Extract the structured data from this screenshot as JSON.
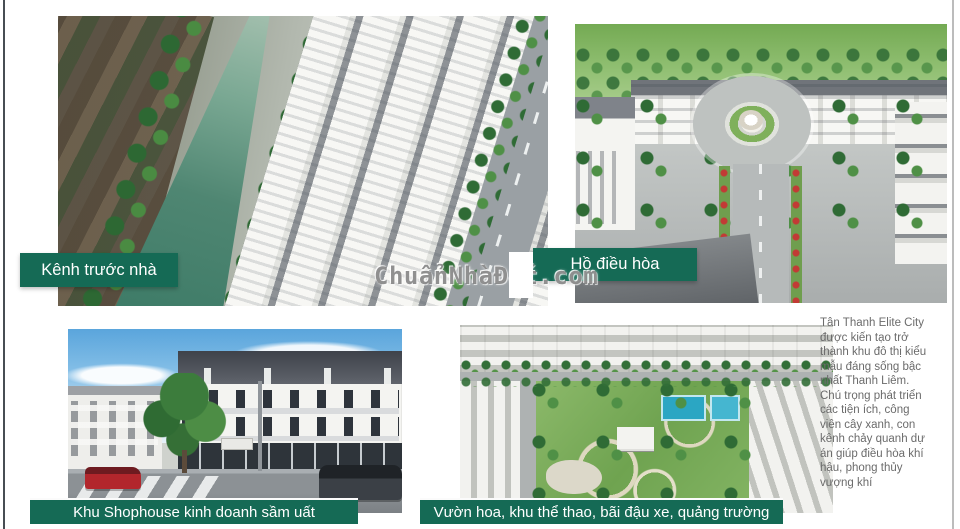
{
  "page": {
    "watermark": "ChuẩnNhàĐất.com",
    "accent_green": "#156a55",
    "background": "#ffffff"
  },
  "gallery": [
    {
      "name": "canal-view",
      "caption": "Kênh trước nhà"
    },
    {
      "name": "lake-view",
      "caption": "Hồ điều hòa"
    },
    {
      "name": "shophouse-view",
      "caption": "Khu Shophouse kinh doanh sầm uất"
    },
    {
      "name": "park-view",
      "caption": "Vườn hoa, khu thể thao, bãi đậu xe, quảng trường"
    }
  ],
  "description": "Tân Thanh Elite City được kiến tạo trở thành khu đô thị kiểu mẫu đáng sống bậc nhất Thanh Liêm. Chú trọng phát triển các tiện ích, công viên cây xanh, con kênh chảy quanh dự án giúp điều hòa khí hậu, phong thủy vượng khí"
}
